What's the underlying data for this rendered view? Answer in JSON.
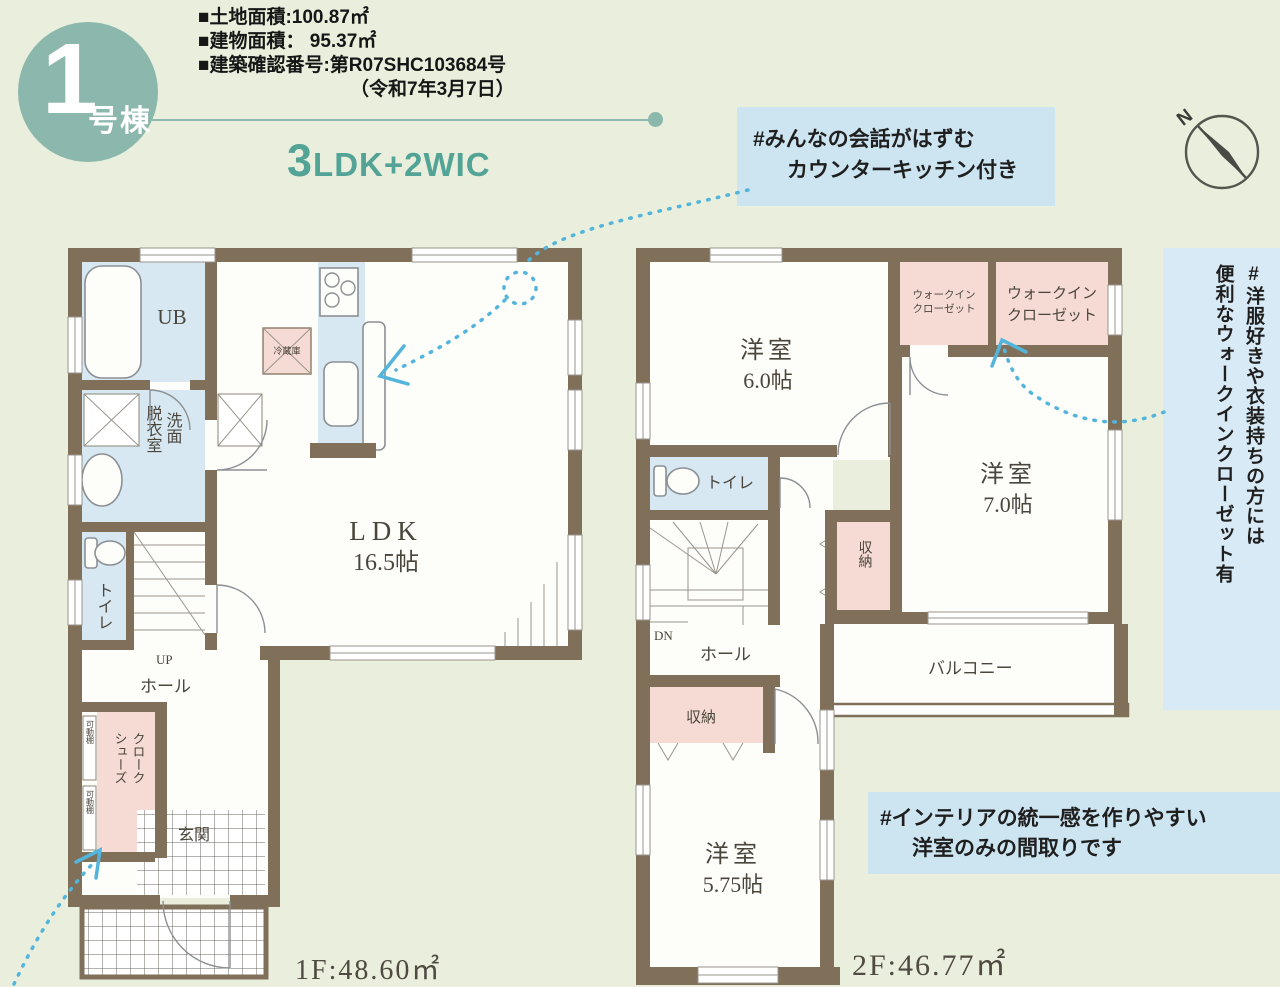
{
  "header": {
    "badge_number": "1",
    "badge_suffix": "号棟",
    "info_lines": [
      "■土地面積:100.87㎡",
      "■建物面積： 95.37㎡",
      "■建築確認番号:第R07SHC103684号",
      "（令和7年3月7日）"
    ],
    "layout_big": "3",
    "layout_rest": "LDK+2WIC"
  },
  "notes": {
    "kitchen_line1": "#みんなの会話がはずむ",
    "kitchen_line2": "カウンターキッチン付き",
    "wic_col1": "#洋服好きや衣装持ちの方には",
    "wic_col2": "便利なウォークインクローゼット有",
    "interior_line1": "#インテリアの統一感を作りやすい",
    "interior_line2": "洋室のみの間取りです"
  },
  "compass": {
    "north": "N"
  },
  "floor1": {
    "area": "1F:48.60㎡",
    "ub": "UB",
    "washroom_right": "洗面",
    "washroom_left": "脱衣室",
    "toilet": "トイレ",
    "stairs_up": "UP",
    "hall": "ホール",
    "ldk": "LDK",
    "ldk_size": "16.5帖",
    "fridge": "冷蔵庫",
    "shoes_closet_line1": "シューズ",
    "shoes_closet_line2": "クローク",
    "shelf": "可動棚",
    "entrance": "玄関"
  },
  "floor2": {
    "area": "2F:46.77㎡",
    "bedroom1": "洋室",
    "bedroom1_size": "6.0帖",
    "bedroom2": "洋室",
    "bedroom2_size": "7.0帖",
    "bedroom3": "洋室",
    "bedroom3_size": "5.75帖",
    "wic_small_line1": "ウォークイン",
    "wic_small_line2": "クローゼット",
    "wic_large_line1": "ウォークイン",
    "wic_large_line2": "クローゼット",
    "toilet": "トイレ",
    "stairs_down": "DN",
    "hall": "ホール",
    "storage_upper": "収納",
    "storage_lower": "収納",
    "balcony": "バルコニー"
  }
}
